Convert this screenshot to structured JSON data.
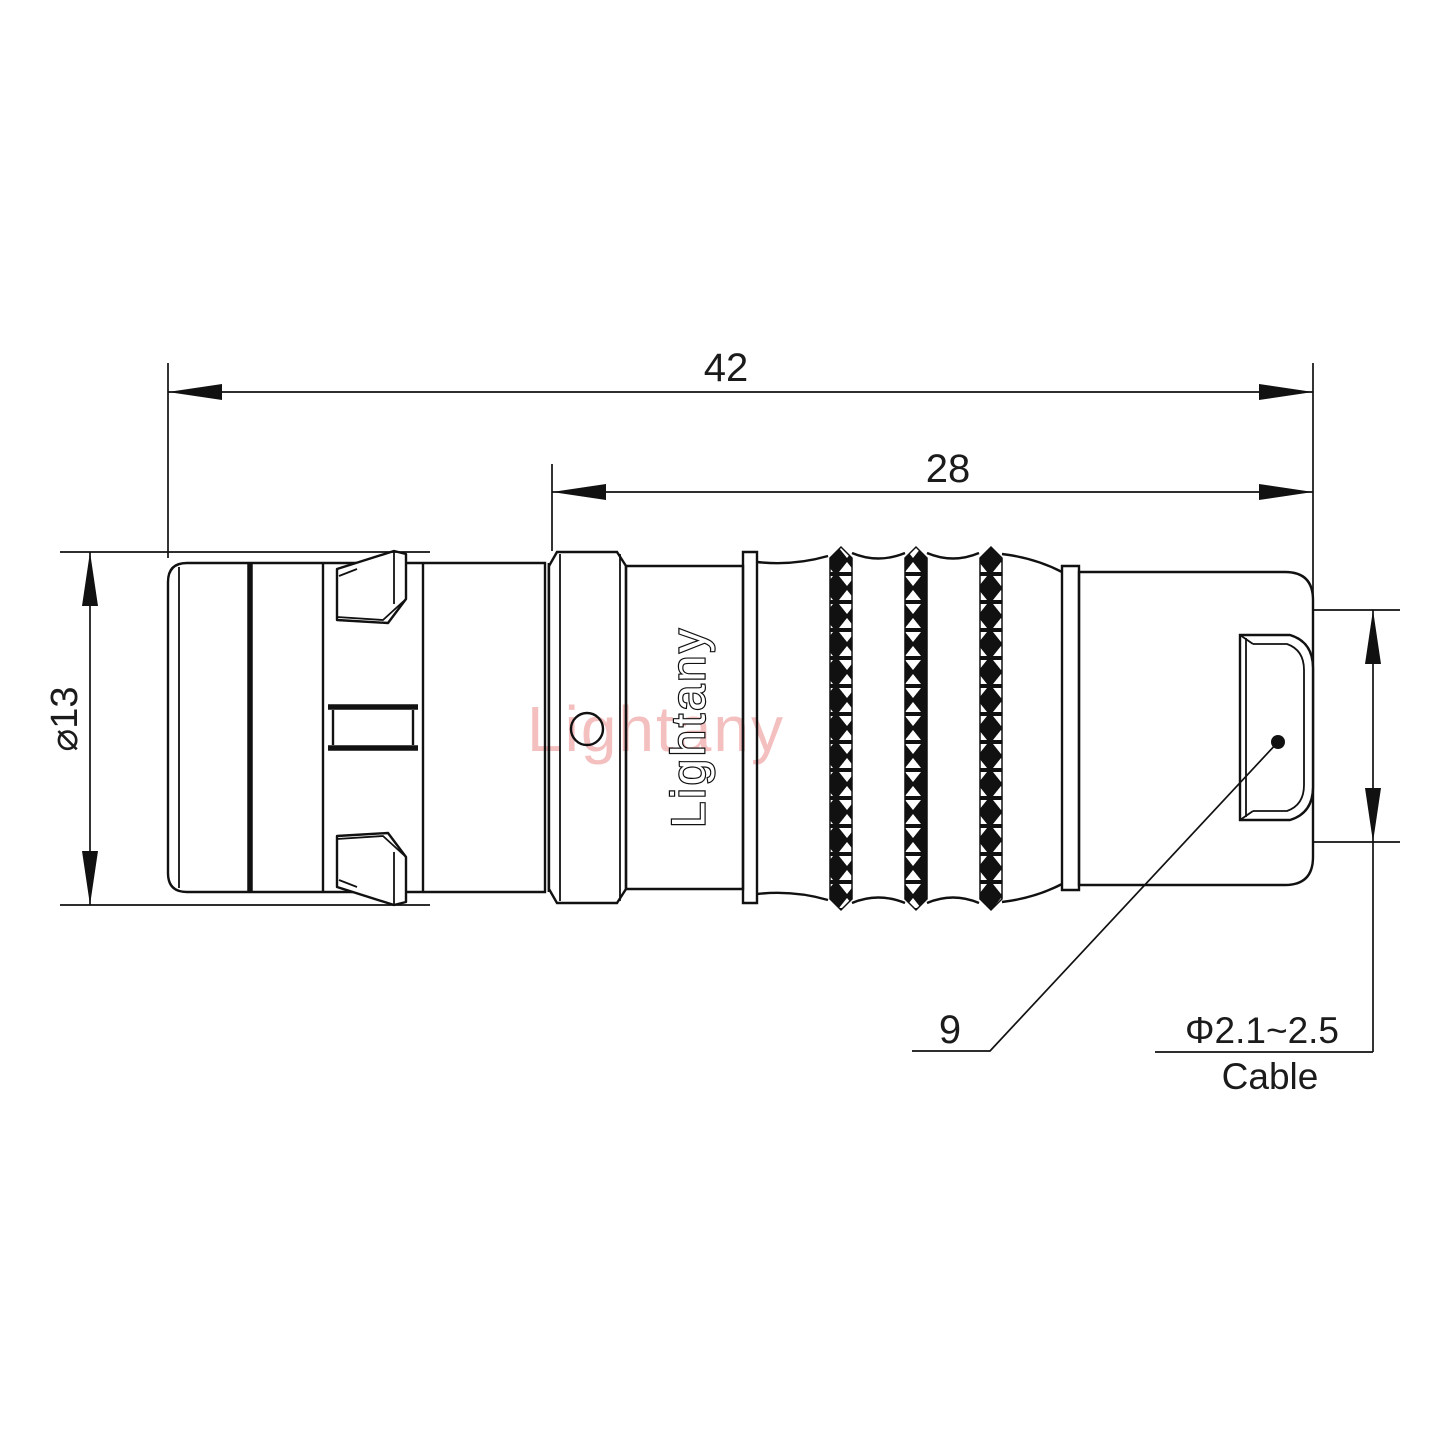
{
  "dimensions": {
    "total_length": "42",
    "rear_section_length": "28",
    "outer_diameter": "⌀13",
    "part_reference": "9",
    "cable_diameter": "Φ2.1~2.5",
    "cable_label": "Cable"
  },
  "branding": {
    "engraving": "Lightany",
    "watermark": "Lightany"
  },
  "colors": {
    "line": "#111111",
    "watermark": "#f4bcbc",
    "background": "#ffffff"
  }
}
